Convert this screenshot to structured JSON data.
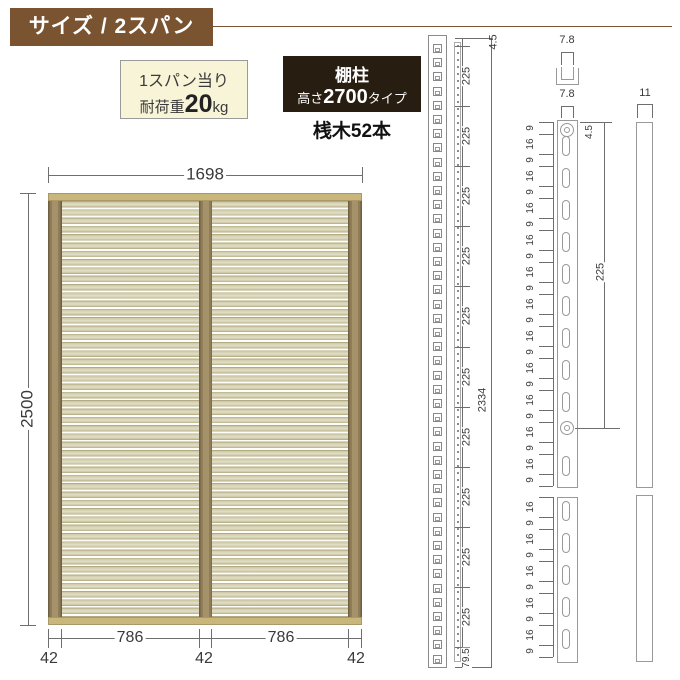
{
  "header": {
    "title": "サイズ / 2スパン"
  },
  "badges": {
    "load": {
      "line1": "1スパン当り",
      "prefix": "耐荷重",
      "value": "20",
      "unit": "kg"
    },
    "post": {
      "title": "棚柱",
      "prefix": "高さ",
      "value": "2700",
      "suffix": "タイプ"
    },
    "note": "桟木52本"
  },
  "panel_dims": {
    "width": "1698",
    "height": "2500",
    "spans": [
      "786",
      "786"
    ],
    "posts": [
      "42",
      "42",
      "42"
    ]
  },
  "left_detail": {
    "top": "4.5",
    "segments": [
      "225",
      "225",
      "225",
      "225",
      "225",
      "225",
      "225",
      "225",
      "225",
      "225"
    ],
    "bottom": "79.5",
    "total": "2334",
    "slot_count": 44
  },
  "right_detail": {
    "channel_width": "7.8",
    "slot_width": "7.8",
    "side_width": "11",
    "top_offset": "4.5",
    "hole_pitch": "225",
    "pitch_top": [
      "9",
      "16",
      "9",
      "16",
      "9",
      "16",
      "9",
      "16",
      "9",
      "16",
      "9",
      "16",
      "9",
      "16",
      "9",
      "16",
      "9",
      "16",
      "9",
      "16",
      "9",
      "16",
      "9"
    ],
    "pitch_bottom": [
      "16",
      "9",
      "16",
      "9",
      "16",
      "9",
      "16",
      "9",
      "16",
      "9"
    ],
    "slots_top": 11,
    "slots_bottom": 5
  },
  "colors": {
    "header_bg": "#7a5331",
    "badge_bg": "#f8f4d8",
    "dark_badge_bg": "#271d11",
    "rail": "#c9b67a",
    "post_brown": "#8f7d58",
    "slat": "#ccc6a2",
    "dim_line": "#6e6e6e"
  }
}
